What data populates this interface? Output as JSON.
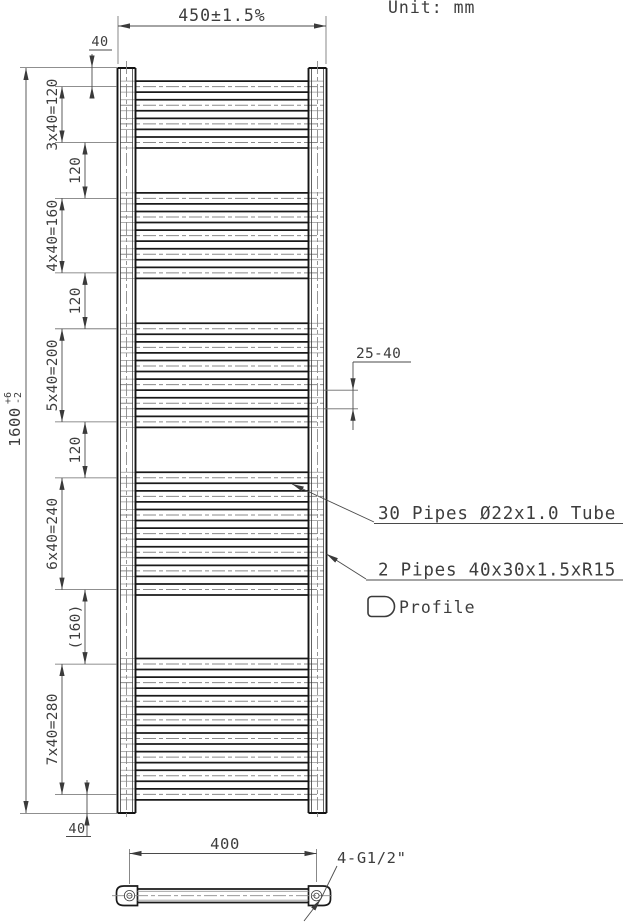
{
  "header": {
    "unit": "Unit: mm"
  },
  "front_view": {
    "dim_width": "450±1.5%",
    "dim_height": {
      "value": "1600",
      "tol_plus": "+6",
      "tol_minus": "-2"
    },
    "dim_top_margin": "40",
    "dim_bottom_margin": "40",
    "chain_dims": [
      {
        "label": "3x40=120"
      },
      {
        "label": "120"
      },
      {
        "label": "4x40=160"
      },
      {
        "label": "120"
      },
      {
        "label": "5x40=200"
      },
      {
        "label": "120"
      },
      {
        "label": "6x40=240"
      },
      {
        "label": "(160)"
      },
      {
        "label": "7x40=280"
      }
    ],
    "dim_pipe_pitch": "25-40"
  },
  "radiator": {
    "total_height_mm": 1600,
    "width_mm": 450,
    "pipe_count": 30,
    "pipe_pitch_mm": 40,
    "pipe_groups": [
      {
        "count": 4,
        "start_mm": 40
      },
      {
        "count": 5,
        "start_mm": 280
      },
      {
        "count": 6,
        "start_mm": 560
      },
      {
        "count": 7,
        "start_mm": 880
      },
      {
        "count": 8,
        "start_mm": 1280
      }
    ]
  },
  "annotations": {
    "pipes_note": "30 Pipes Ø22x1.0 Tube",
    "frame_note": "2 Pipes 40x30x1.5xR15 T",
    "profile_label": "Profile"
  },
  "bottom_view": {
    "dim_spacing": "400",
    "connections_label": "4-G1/2\""
  }
}
